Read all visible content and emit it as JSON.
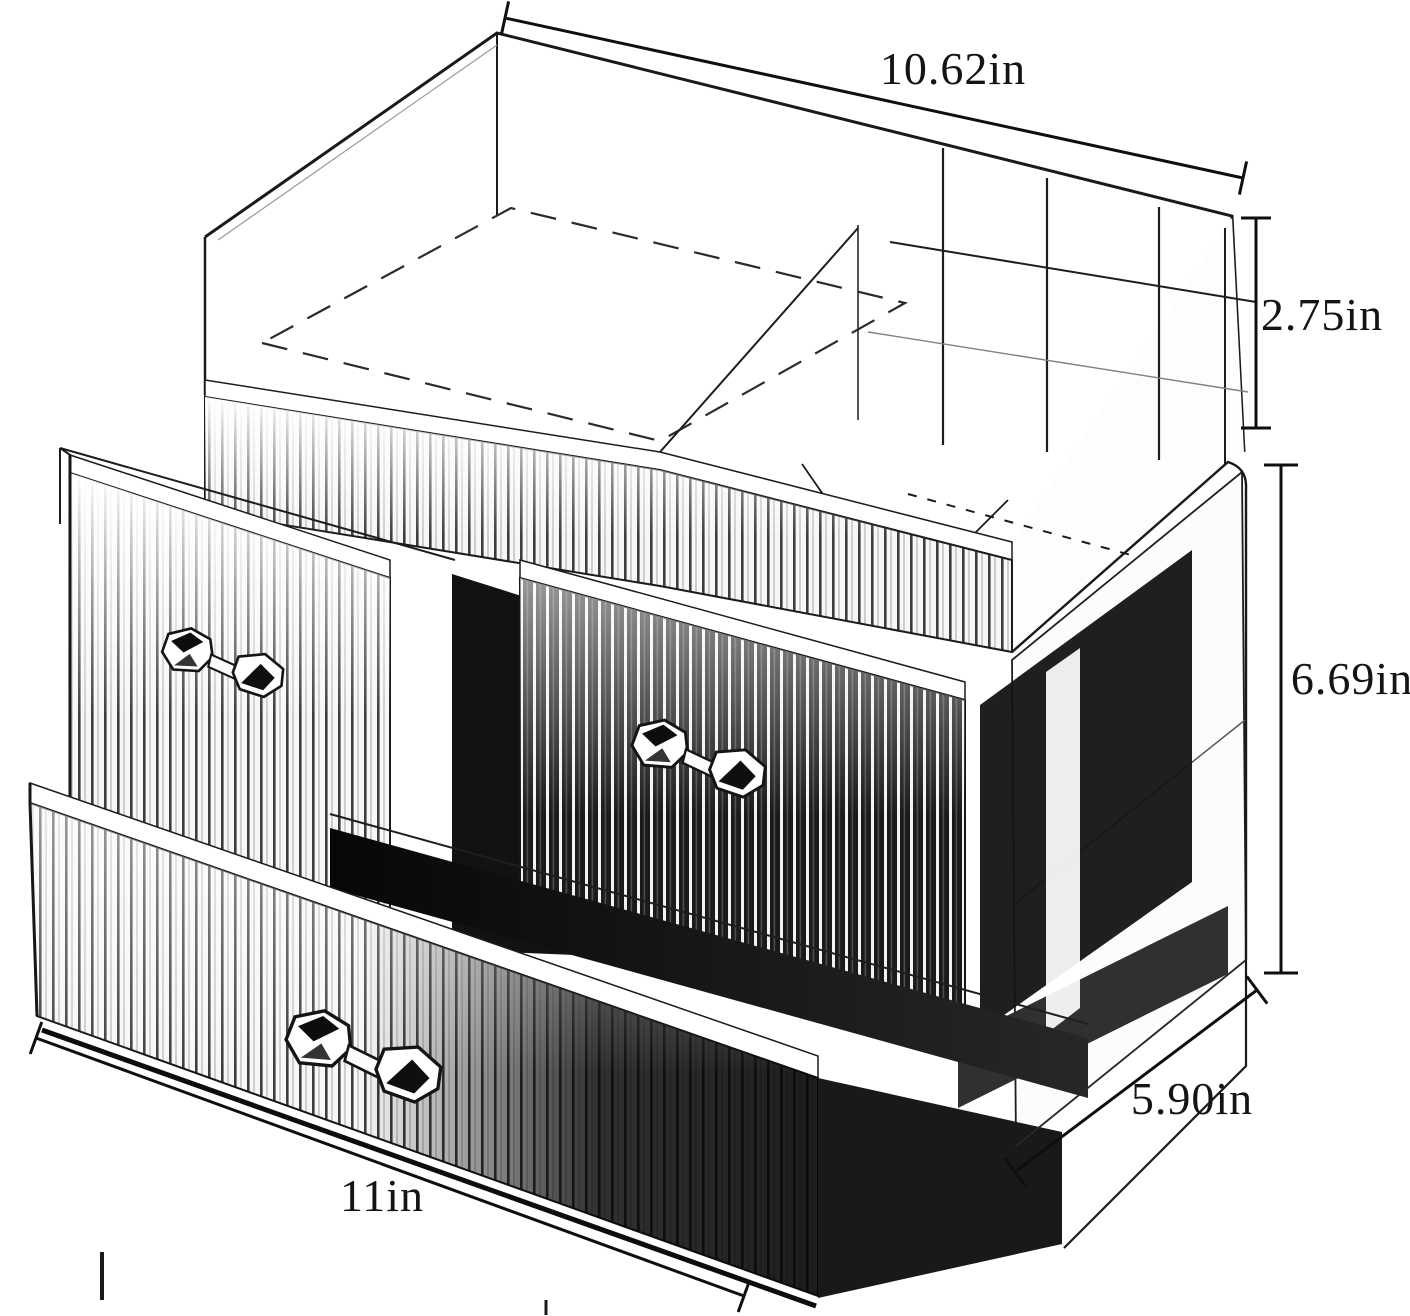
{
  "figure": {
    "type": "product-dimension-diagram",
    "subject": "clear acrylic cosmetic organizer with ribbed drawer fronts and crystal handles"
  },
  "dimensions": {
    "top_width": "10.62in",
    "top_section_height": "2.75in",
    "lower_section_height": "6.69in",
    "depth": "5.90in",
    "bottom_width": "11in"
  },
  "style": {
    "background": "#ffffff",
    "line_color": "#141414",
    "cavity_color": "#131313"
  }
}
